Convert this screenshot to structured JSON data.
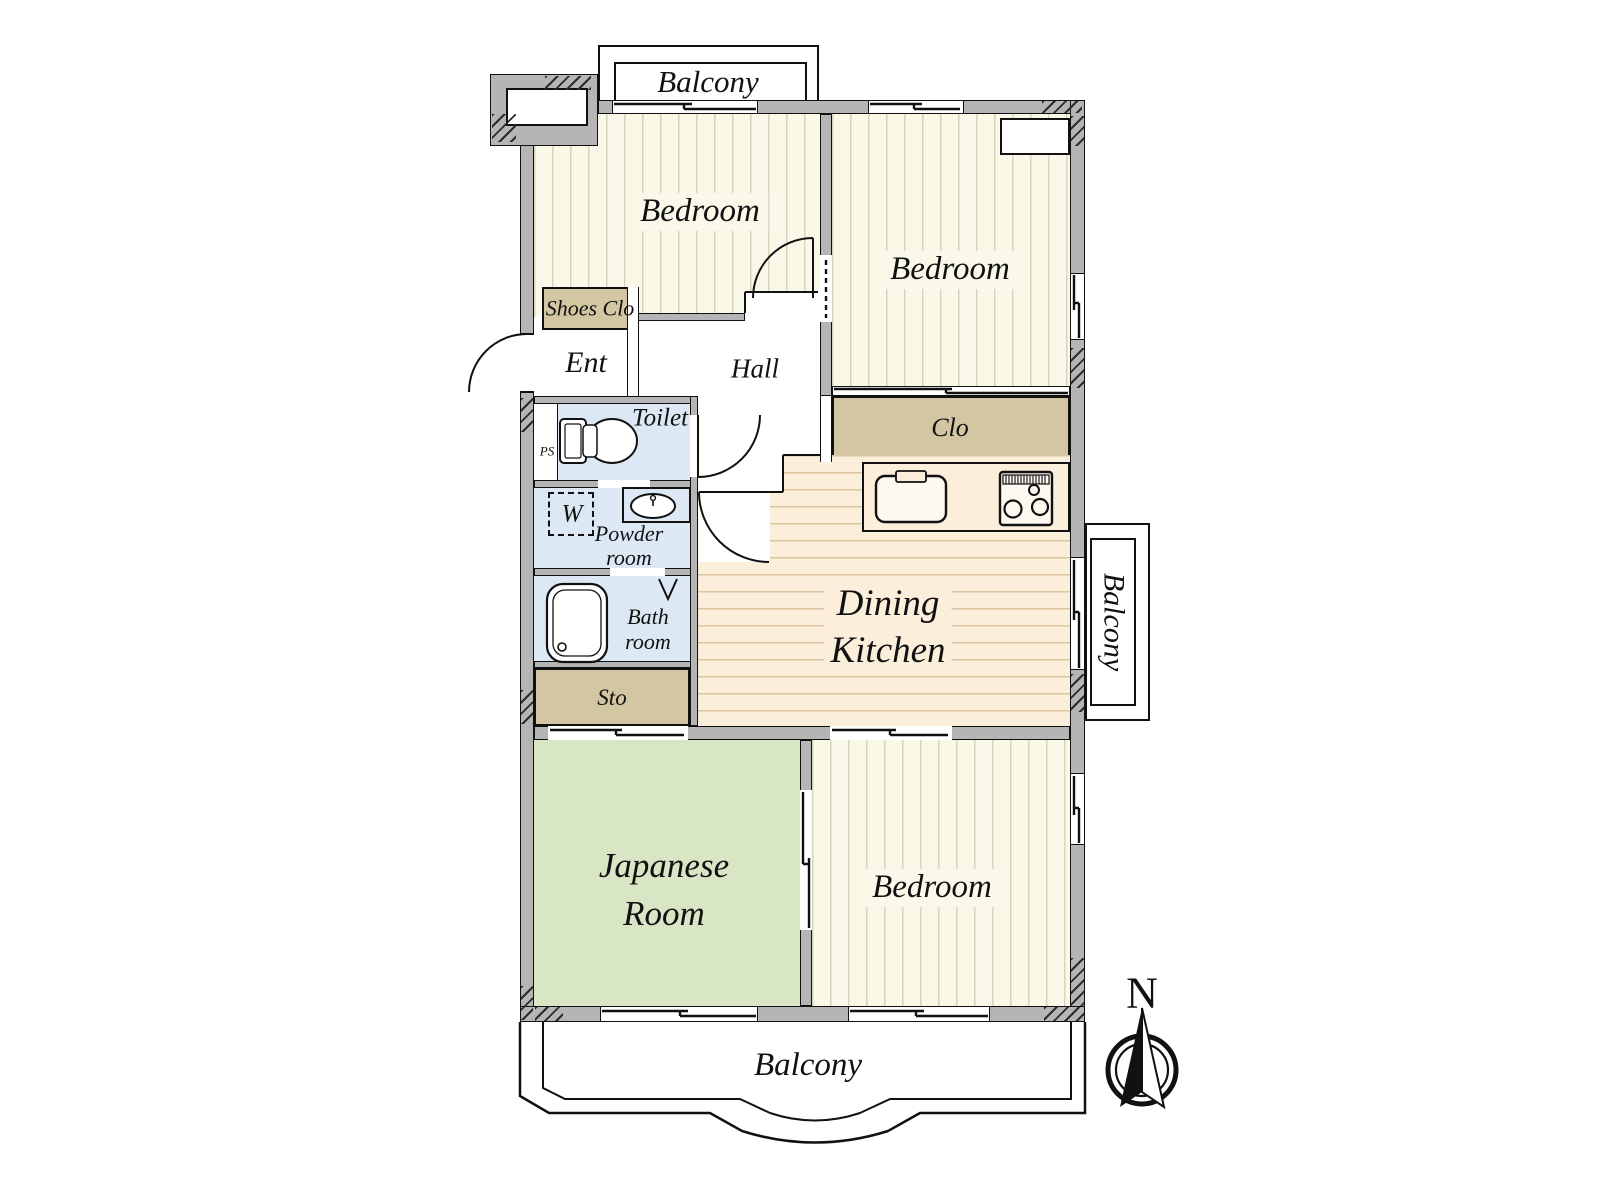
{
  "rooms": {
    "bedroom_top_left": "Bedroom",
    "bedroom_top_right": "Bedroom",
    "bedroom_bottom": "Bedroom",
    "japanese_room": [
      "Japanese",
      "Room"
    ],
    "dining_kitchen": [
      "Dining",
      "Kitchen"
    ],
    "hall": "Hall",
    "entrance": "Ent",
    "toilet": "Toilet",
    "powder_room": [
      "Powder",
      "room"
    ],
    "bath_room": [
      "Bath",
      "room"
    ],
    "shoes_closet": "Shoes Clo",
    "closet": "Clo",
    "storage": "Sto",
    "pipe_shaft": "PS",
    "washing_machine": "W"
  },
  "balconies": {
    "top": "Balcony",
    "right": "Balcony",
    "bottom": "Balcony"
  },
  "compass": {
    "north": "N"
  },
  "colors": {
    "wall": "#b5b5b5",
    "bedroom_floor": "#faf8e8",
    "dining_floor": "#fbeedb",
    "japanese_floor": "#d8e6c6",
    "wet_area": "#dce9f5",
    "closet": "#d2c7a2"
  }
}
